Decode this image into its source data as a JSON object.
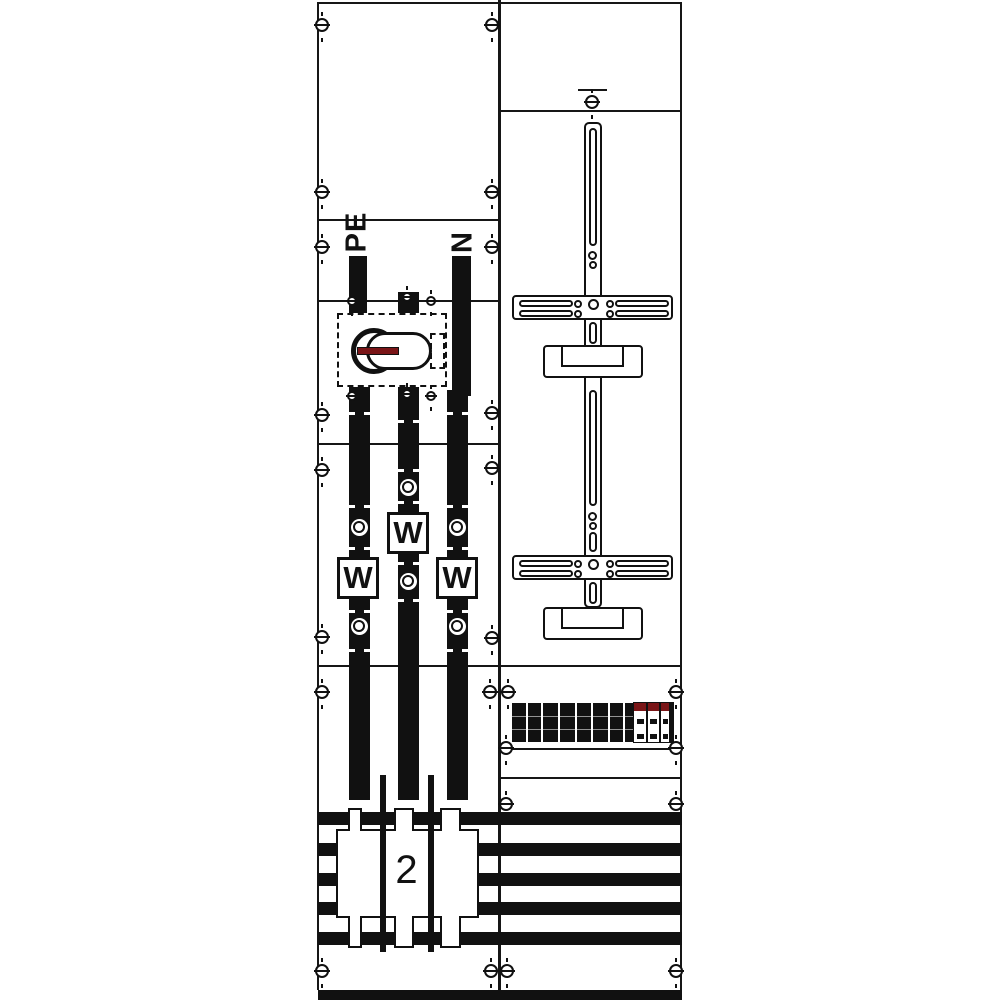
{
  "drawing": {
    "background": "#ffffff",
    "line_color": "#161616",
    "fill_color": "#111111",
    "accent_red": "#7a1517",
    "left_panel": {
      "pe_label": "PE",
      "n_label": "N",
      "meters": [
        {
          "label": "W"
        },
        {
          "label": "W"
        },
        {
          "label": "W"
        }
      ],
      "main_switch": {
        "handle_color": "#7a1517"
      }
    },
    "busbar_section": {
      "cover_label": "2",
      "bus_count": 5
    },
    "icons": {
      "screw": "slotted-screw-icon",
      "hole": "busbar-hole-icon",
      "switch": "rotary-switch-icon"
    }
  }
}
